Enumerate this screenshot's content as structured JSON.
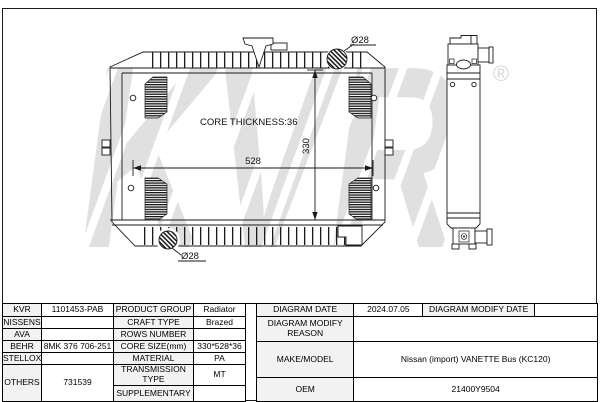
{
  "watermark": {
    "text": "KVR",
    "registered_mark": "®"
  },
  "drawing": {
    "core_thickness_label": "CORE THICKNESS:36",
    "core_width": "528",
    "core_height": "330",
    "top_inlet_diameter": "Ø28",
    "bottom_outlet_diameter": "Ø28"
  },
  "colors": {
    "line": "#1a1a1a",
    "label_cell_bg": "#f2f2f2",
    "watermark_gray": "#e0e0e0"
  },
  "table": {
    "left": {
      "rows": [
        {
          "label": "KVR",
          "value": "1101453-PAB",
          "attr": "PRODUCT GROUP",
          "attr_value": "Radiator"
        },
        {
          "label": "NISSENS",
          "value": "",
          "attr": "CRAFT TYPE",
          "attr_value": "Brazed"
        },
        {
          "label": "AVA",
          "value": "",
          "attr": "ROWS NUMBER",
          "attr_value": ""
        },
        {
          "label": "BEHR",
          "value": "8MK 376 706-251",
          "attr": "CORE SIZE(mm)",
          "attr_value": "330*528*36"
        },
        {
          "label": "STELLOX",
          "value": "",
          "attr": "MATERIAL",
          "attr_value": "PA"
        },
        {
          "label": "OTHERS",
          "value": "731539",
          "attr": "TRANSMISSION TYPE",
          "attr_value": "MT"
        },
        {
          "attr": "SUPPLEMENTARY",
          "attr_value": ""
        }
      ]
    },
    "right": {
      "diagram_date_label": "DIAGRAM DATE",
      "diagram_date": "2024.07.05",
      "diagram_modify_date_label": "DIAGRAM MODIFY DATE",
      "diagram_modify_date": "",
      "diagram_modify_reason_label": "DIAGRAM MODIFY REASON",
      "diagram_modify_reason": "",
      "make_model_label": "MAKE/MODEL",
      "make_model": "Nissan (import) VANETTE Bus (KC120)",
      "oem_label": "OEM",
      "oem": "21400Y9504"
    }
  }
}
